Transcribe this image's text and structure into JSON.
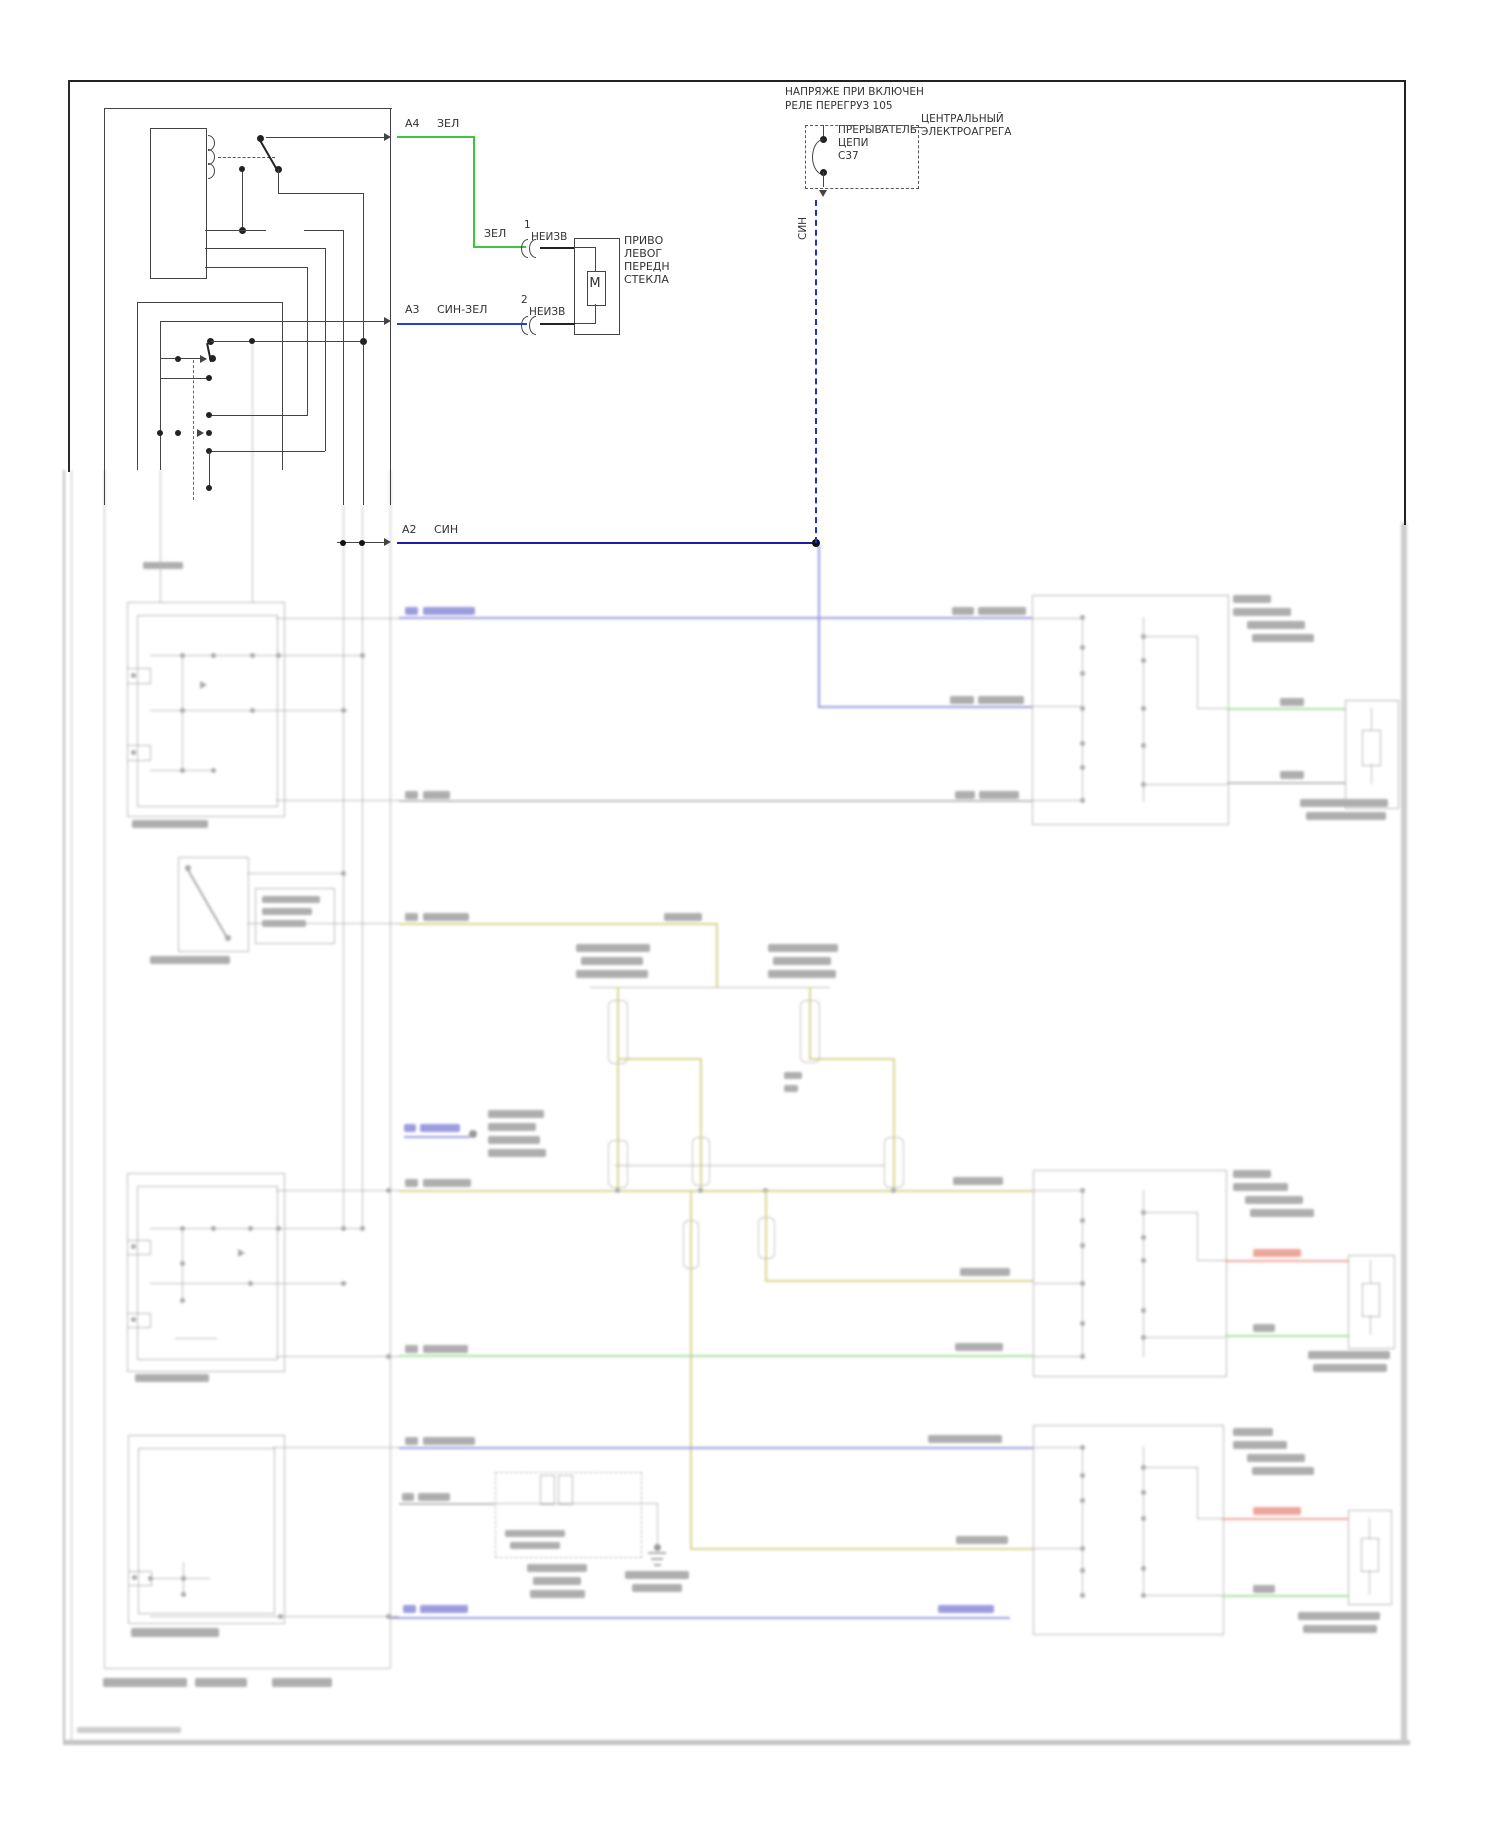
{
  "page": {
    "wire_labels": {
      "a4_pin": "A4",
      "a4_color": "ЗЕЛ",
      "a3_pin": "A3",
      "a3_color": "СИН-ЗЕЛ",
      "a2_pin": "A2",
      "a2_color": "СИН",
      "seg_green": "ЗЕЛ",
      "vertical_blue": "СИН"
    },
    "connector": {
      "pin1": "1",
      "terminal1": "НЕИЗВ",
      "pin2": "2",
      "terminal2": "НЕИЗВ"
    },
    "motor": {
      "symbol": "M",
      "name_lines": [
        "ПРИВО",
        "ЛЕВОГ",
        "ПЕРЕДН",
        "СТЕКЛА"
      ]
    },
    "relay_note": [
      "НАПРЯЖЕ ПРИ ВКЛЮЧЕН",
      "РЕЛЕ ПЕРЕГРУЗ 105"
    ],
    "breaker": [
      "ПРЕРЫВАТЕЛЬ",
      "ЦЕПИ",
      "C37"
    ],
    "central_unit": [
      "ЦЕНТРАЛЬНЫЙ",
      "ЭЛЕКТРОАГРЕГА"
    ],
    "colors": {
      "green_wire": "#3ec43e",
      "blue_wire": "#2244cc",
      "navy_wire": "#1d1da8",
      "dashed_blue": "#2233bb",
      "line": "#444444"
    }
  }
}
